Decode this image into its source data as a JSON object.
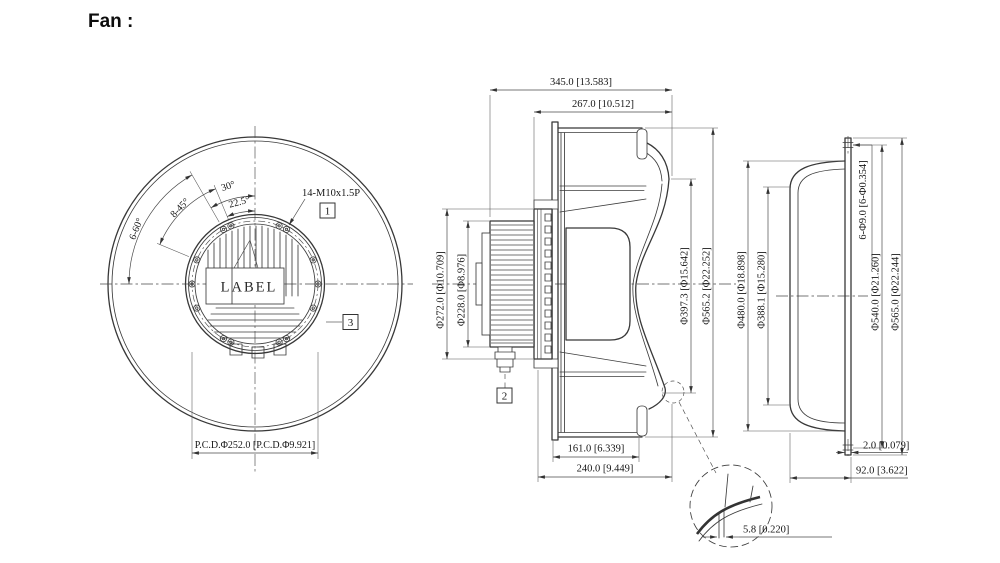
{
  "title": "Fan :",
  "colors": {
    "line_color": "#3a3a3a",
    "text_color": "#161616",
    "background": "#ffffff"
  },
  "front_view": {
    "angles": {
      "a30": "30°",
      "a22_5": "22.5°",
      "a8_45": "8-45°",
      "a6_60": "6-60°"
    },
    "thread_callout": "14-M10x1.5P",
    "balloon_1": "1",
    "balloon_3": "3",
    "label": "LABEL",
    "pcd": "P.C.D.Φ252.0 [P.C.D.Φ9.921]"
  },
  "side_view": {
    "overall_depth": "345.0 [13.583]",
    "housing_depth": "267.0 [10.512]",
    "motor_flange_dia": "Φ272.0 [Φ10.709]",
    "motor_body_dia": "Φ228.0 [Φ8.976]",
    "inlet_dia": "Φ397.3 [Φ15.642]",
    "impeller_dia": "Φ565.2 [Φ22.252]",
    "balloon_2": "2",
    "wheel_depth": "161.0 [6.339]",
    "assembly_depth": "240.0 [9.449]"
  },
  "inlet_ring_view": {
    "bolt_holes": "6-Φ9.0 [6-Φ0.354]",
    "opening_dia": "Φ480.0 [Φ18.898]",
    "throat_dia": "Φ388.1 [Φ15.280]",
    "bolt_circle_dia": "Φ540.0 [Φ21.260]",
    "outer_dia": "Φ565.0 [Φ22.244]",
    "plate_thickness": "2.0 [0.079]",
    "ring_depth": "92.0 [3.622]"
  },
  "detail_view": {
    "lip_thickness": "5.8 [0.220]"
  }
}
